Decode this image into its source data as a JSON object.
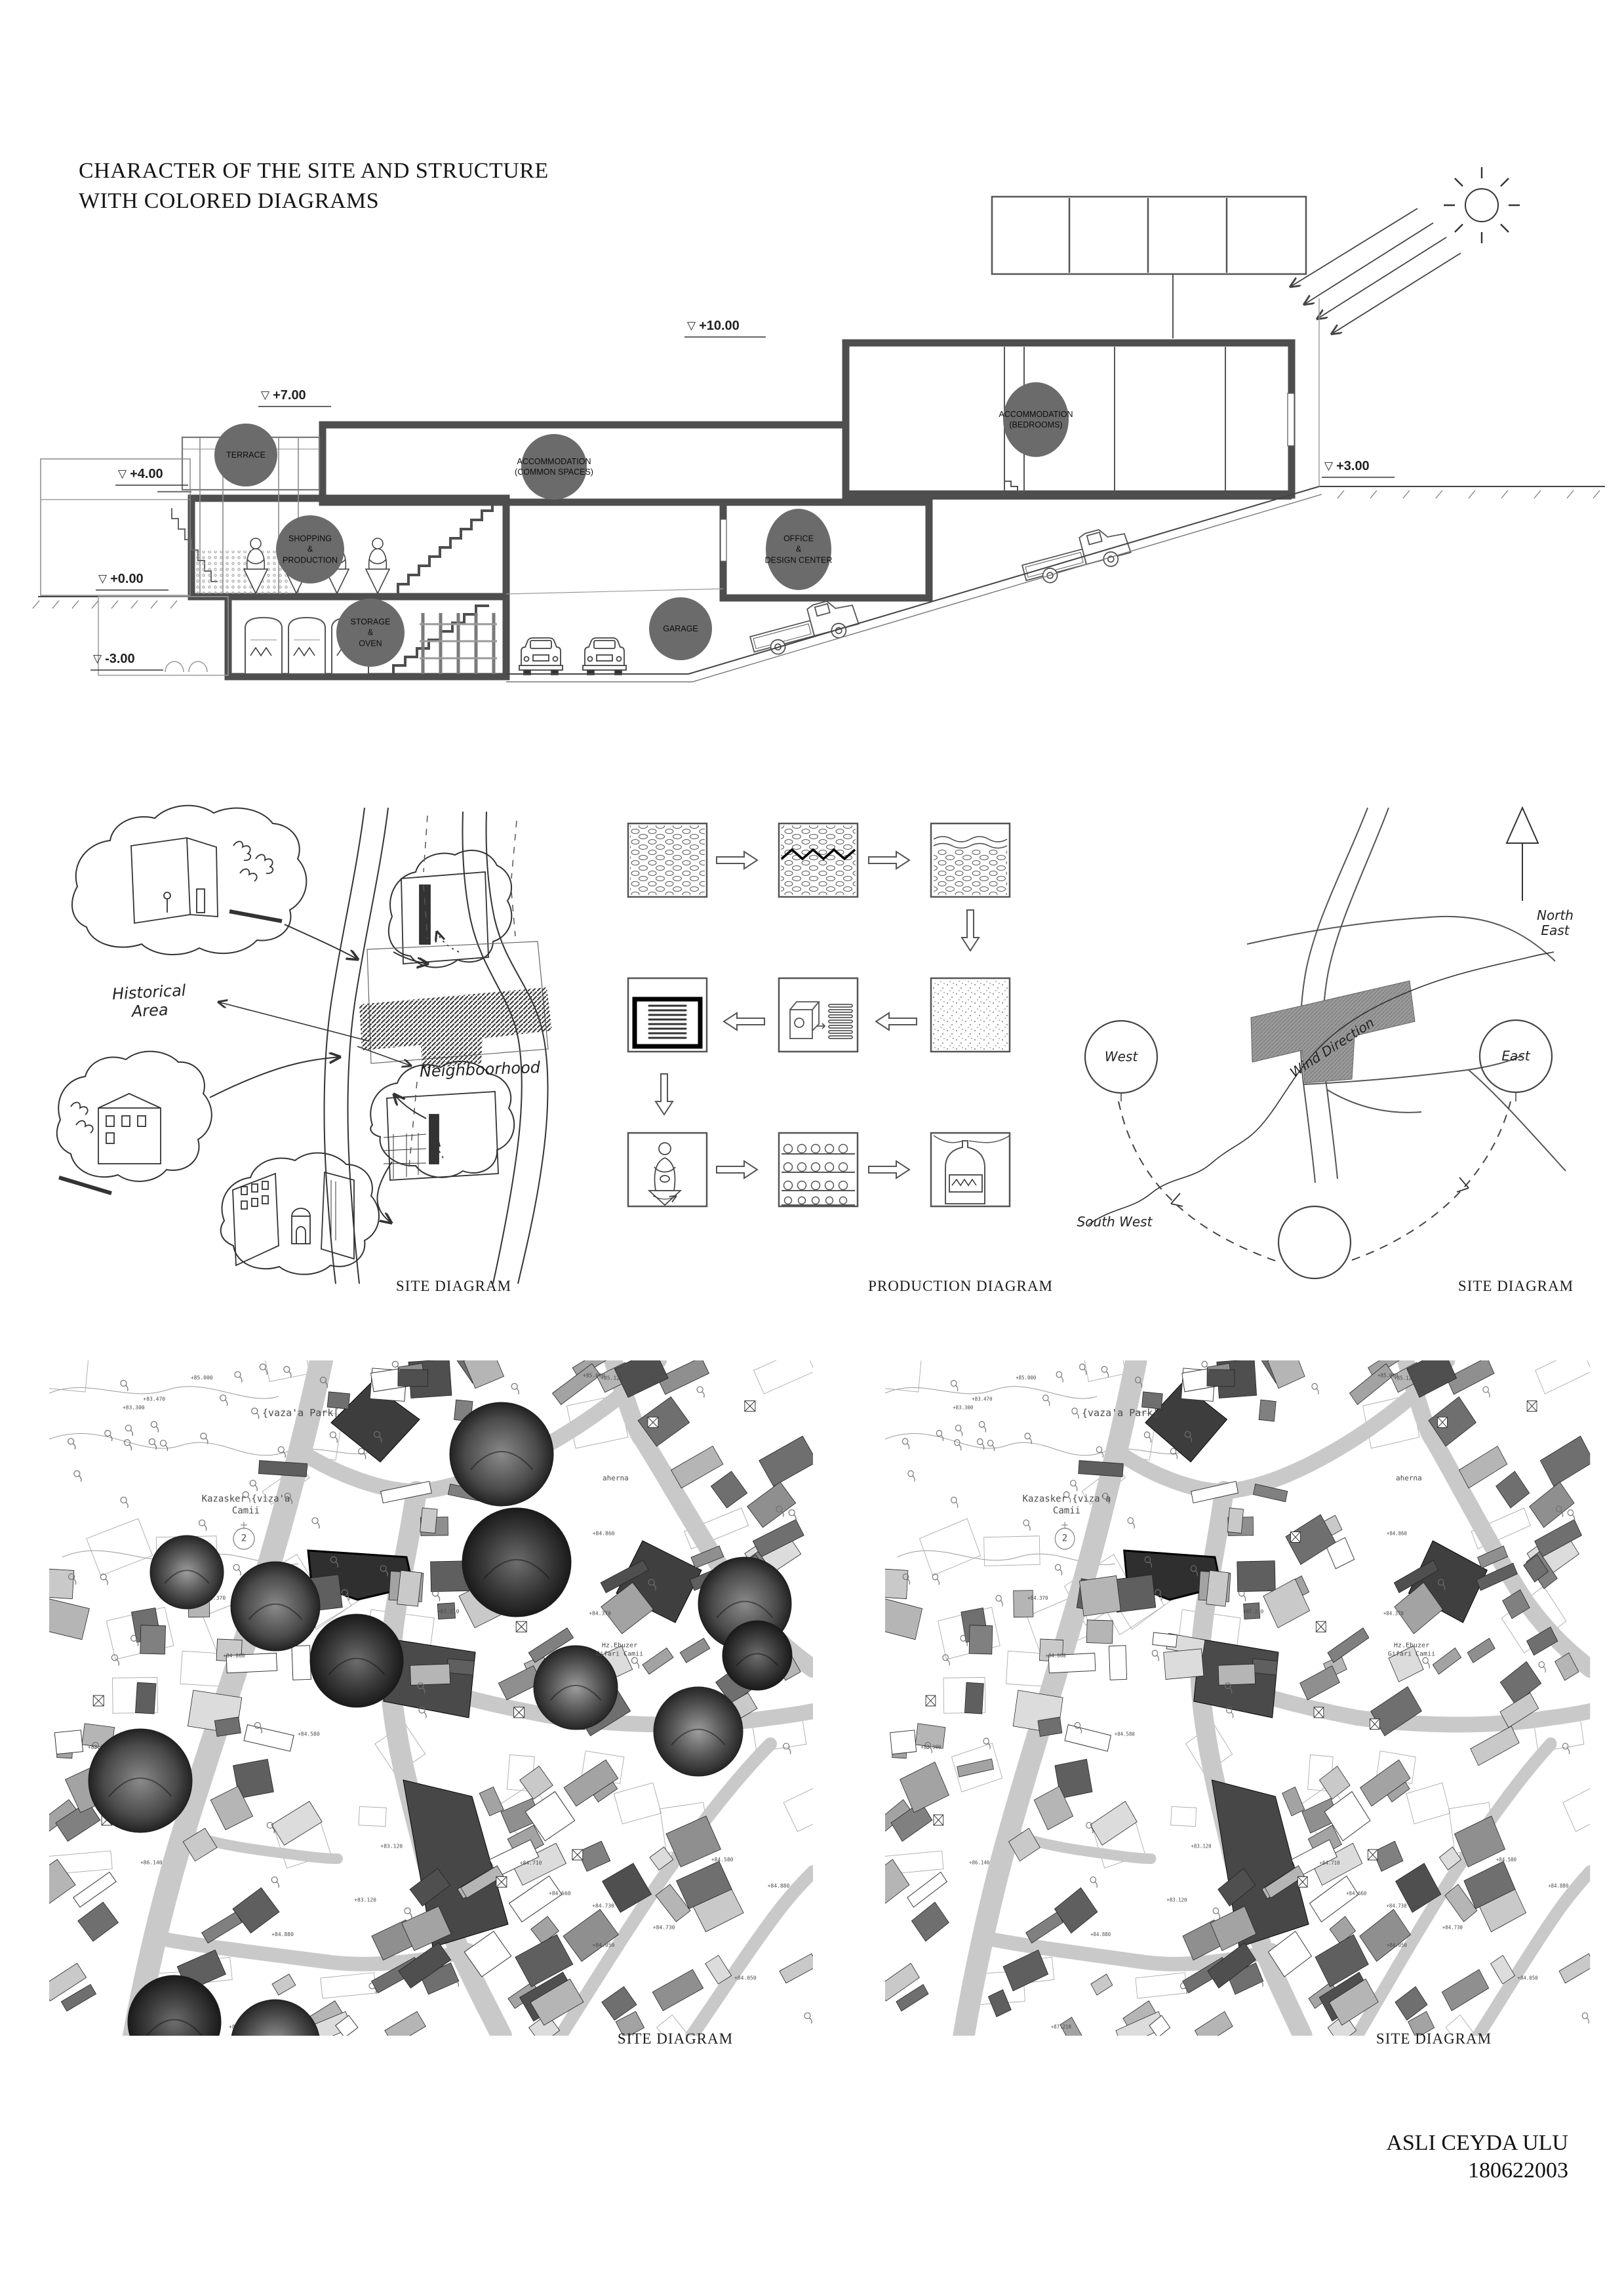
{
  "page": {
    "title_line1": "CHARACTER OF THE SITE AND STRUCTURE",
    "title_line2": "WITH COLORED DIAGRAMS",
    "author_name": "ASLI CEYDA ULU",
    "author_id": "180622003"
  },
  "icons": {
    "level_triangle": "▽"
  },
  "section": {
    "levels": [
      {
        "label": "+10.00"
      },
      {
        "label": "+7.00"
      },
      {
        "label": "+4.00"
      },
      {
        "label": "+0.00"
      },
      {
        "label": "-3.00"
      },
      {
        "label": "+3.00"
      }
    ],
    "spaces": [
      {
        "label": "TERRACE"
      },
      {
        "label": "ACCOMMODATION\n(COMMON SPACES)"
      },
      {
        "label": "ACCOMMODATION\n(BEDROOMS)"
      },
      {
        "label": "SHOPPING\n&\nPRODUCTION"
      },
      {
        "label": "OFFICE\n&\nDESIGN CENTER"
      },
      {
        "label": "STORAGE\n&\nOVEN"
      },
      {
        "label": "GARAGE"
      }
    ],
    "space_color": "#6b6b6b",
    "wall_color": "#4e4e4e"
  },
  "sketch_diagram": {
    "caption": "SITE DIAGRAM",
    "historical_label": "Historical\nArea",
    "neighbourhood_label": "Neighboorhood"
  },
  "production_diagram": {
    "caption": "PRODUCTION DIAGRAM"
  },
  "wind_diagram": {
    "caption": "SITE DIAGRAM",
    "west": "West",
    "east": "East",
    "north_east": "North\nEast",
    "south_west": "South West",
    "wind_direction": "Wind Direction"
  },
  "maps": {
    "left_caption": "SITE DIAGRAM",
    "right_caption": "SITE DIAGRAM",
    "park_label": "{vaza'a  Park[",
    "mosque_label": "Kazasker  {viza'a\nCamii",
    "mosque_number": "2",
    "hz_label": "Hz.Ebuzer\nGifari Camii",
    "bath_label": "aherna",
    "street_color": "#c9c9c9",
    "spot_elevations": [
      "+84.730",
      "+84.710",
      "+84.370",
      "+84.860",
      "+84.050",
      "+83.120",
      "+85.000",
      "+84.580",
      "+87.210",
      "+83.300",
      "+84.880",
      "+85.120",
      "+86.140",
      "+84.660",
      "+83.470"
    ]
  }
}
